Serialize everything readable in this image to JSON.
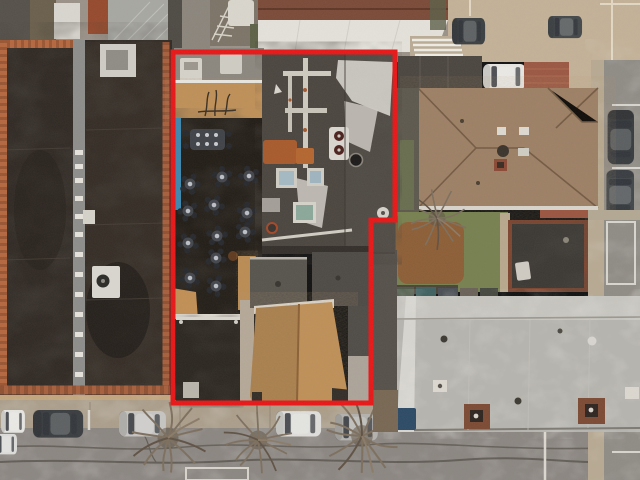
{
  "scene": {
    "kind": "aerial-drone-photograph",
    "subject": "top-down aerial view of a commercial property marked with a red boundary outline, neighboring rooftops, and streets with parked cars",
    "boundary": {
      "color": "#e81617",
      "stroke_width": 5,
      "points": "173,52 395,52 395,220 371,220 371,403 173,403"
    },
    "colors": {
      "top_band": "#9a9288",
      "road": "#8b8681",
      "sidewalk": "#ab9e8b",
      "right_street": "#8f8b85",
      "right_sidewalk": "#b7a992",
      "left_roof_a": "#2f2823",
      "left_roof_b": "#342c25",
      "brick_edge": "#b4673f",
      "parapet": "#8d8d8b",
      "patio_deck": "#221c16",
      "tarp_blue": "#3f87ad",
      "shingle": "#c08f55",
      "main_roof": "#4b453f",
      "panel_roof_left": "#57534d",
      "panel_roof_right": "#4d4945",
      "hip_roof": "#9b7e65",
      "warehouse_roof": "#b6b4ae",
      "grass": "#76804f",
      "brush": "#8f5a33",
      "tar_roof": "#3b3834",
      "car_white": "#e6e5e1",
      "car_dark": "#3a3d40",
      "car_silver": "#c6c5c2",
      "skylight_glass": "#a4b9c3",
      "rust": "#a85a2c"
    },
    "counts": {
      "patio_round_tables": 11,
      "patio_long_tables": 1,
      "parked_cars_bottom_street": 6,
      "parked_cars_right_street": 2,
      "parked_cars_top": 3,
      "street_trees": 4,
      "skylights_main_roof": 3,
      "warehouse_chimneys": 2
    }
  }
}
